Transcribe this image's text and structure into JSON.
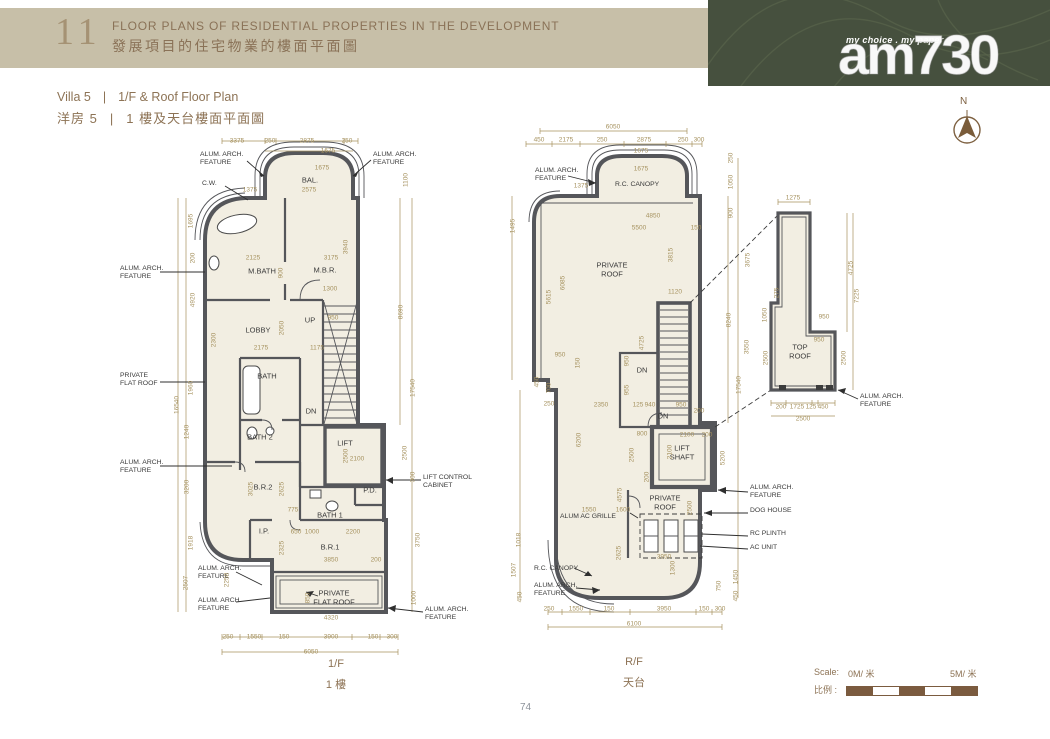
{
  "header": {
    "section_number": "11",
    "title_en": "FLOOR PLANS OF RESIDENTIAL PROPERTIES IN THE DEVELOPMENT",
    "title_zh": "發展項目的住宅物業的樓面平面圖"
  },
  "brand": {
    "tagline": "my choice . my paper",
    "logo": "am730"
  },
  "subtitle": {
    "villa_en": "Villa 5",
    "plan_en": "1/F & Roof Floor Plan",
    "villa_zh": "洋房 5",
    "plan_zh": "1 樓及天台樓面平面圖",
    "divider": "|"
  },
  "compass": {
    "north": "N"
  },
  "scalebar": {
    "label_en": "Scale:",
    "label_zh": "比例 :",
    "start": "0M/ 米",
    "end": "5M/ 米"
  },
  "page": {
    "number": "74"
  },
  "labels": {
    "alum_arch_feature": "ALUM. ARCH.\nFEATURE",
    "private_flat_roof": "PRIVATE\nFLAT ROOF",
    "private_roof": "PRIVATE\nROOF",
    "lift_control_cabinet": "LIFT CONTROL\nCABINET",
    "rc_canopy": "R.C. CANOPY",
    "dog_house": "DOG HOUSE",
    "rc_plinth": "RC PLINTH",
    "ac_unit": "AC UNIT",
    "alum_ac_grille": "ALUM AC GRILLE",
    "lift_shaft": "LIFT\nSHAFT",
    "top_roof": "TOP\nROOF",
    "cw": "C.W.",
    "up": "UP",
    "dn": "DN"
  },
  "plan_1f": {
    "caption_en": "1/F",
    "caption_zh": "1 樓",
    "rooms": {
      "bal": "BAL.",
      "mbath": "M.BATH",
      "mbr": "M.B.R.",
      "lobby": "LOBBY",
      "bath": "BATH",
      "bath2": "BATH 2",
      "lift": "LIFT",
      "br2": "B.R.2",
      "bath1": "BATH 1",
      "br1": "B.R.1",
      "ip": "I.P.",
      "pd": "P.D."
    },
    "dims": {
      "t1": "3375",
      "t2": "250",
      "t3": "2875",
      "t4": "250",
      "t5": "1675",
      "t6": "1675",
      "t7": "2575",
      "t8": "1375",
      "b1": "250",
      "b2": "1550",
      "b3": "150",
      "b4": "3900",
      "b5": "150",
      "b6": "300",
      "b7": "6050",
      "b8": "4320",
      "l1": "1695",
      "l2": "200",
      "l3": "4920",
      "l4": "1960",
      "l5": "16540",
      "l6": "1240",
      "l7": "3200",
      "l8": "1918",
      "l9": "2507",
      "l10": "2258",
      "l11": "2300",
      "r1": "1100",
      "r2": "8690",
      "r3": "17540",
      "r4": "2500",
      "r5": "300",
      "r6": "3750",
      "r7": "1000",
      "i1": "2125",
      "i2": "3175",
      "i3": "900",
      "i4": "1300",
      "i5": "3940",
      "i6": "2175",
      "i7": "1175",
      "i8": "2050",
      "i9": "950",
      "i10": "2500",
      "i11": "2100",
      "i12": "3025",
      "i13": "2625",
      "i14": "775",
      "i15": "650",
      "i16": "1000",
      "i17": "2200",
      "i18": "3850",
      "i19": "2325",
      "i20": "850",
      "i21": "200"
    }
  },
  "plan_rf": {
    "caption_en": "R/F",
    "caption_zh": "天台",
    "dims": {
      "t1": "6050",
      "t2": "450",
      "t3": "2175",
      "t4": "250",
      "t5": "2875",
      "t6": "250",
      "t7": "300",
      "t8": "1675",
      "t9": "1675",
      "t10": "1375",
      "b1": "250",
      "b2": "1550",
      "b3": "150",
      "b4": "3950",
      "b5": "150",
      "b6": "300",
      "b7": "6100",
      "l1": "1495",
      "l2": "5615",
      "l3": "6085",
      "l4": "450",
      "l5": "700",
      "l6": "1018",
      "l7": "1507",
      "l8": "450",
      "l9": "150",
      "r1": "250",
      "r2": "1050",
      "r3": "900",
      "r4": "3675",
      "r5": "8240",
      "r6": "3550",
      "r7": "17540",
      "r8": "1450",
      "r9": "450",
      "i1": "4850",
      "i2": "5500",
      "i3": "150",
      "i4": "950",
      "i5": "2350",
      "i6": "250",
      "i7": "1120",
      "i8": "125",
      "i9": "940",
      "i10": "950",
      "i11": "200",
      "i12": "800",
      "i13": "2100",
      "i14": "200",
      "i15": "1550",
      "i16": "1600",
      "i17": "3950",
      "i18": "3815",
      "i19": "4725",
      "i20": "950",
      "i21": "955",
      "i22": "2500",
      "i23": "2100",
      "i24": "200",
      "i25": "6200",
      "i26": "4575",
      "i27": "2500",
      "i28": "2625",
      "i29": "1300",
      "i30": "750",
      "i31": "5200"
    }
  },
  "top_roof": {
    "dims": {
      "t1": "1275",
      "r1": "4725",
      "r2": "7225",
      "r3": "2500",
      "l1": "275",
      "l2": "1050",
      "l3": "2500",
      "i1": "950",
      "i2": "950",
      "b1": "200",
      "b2": "1725",
      "b3": "125",
      "b4": "450",
      "b5": "2500"
    }
  }
}
